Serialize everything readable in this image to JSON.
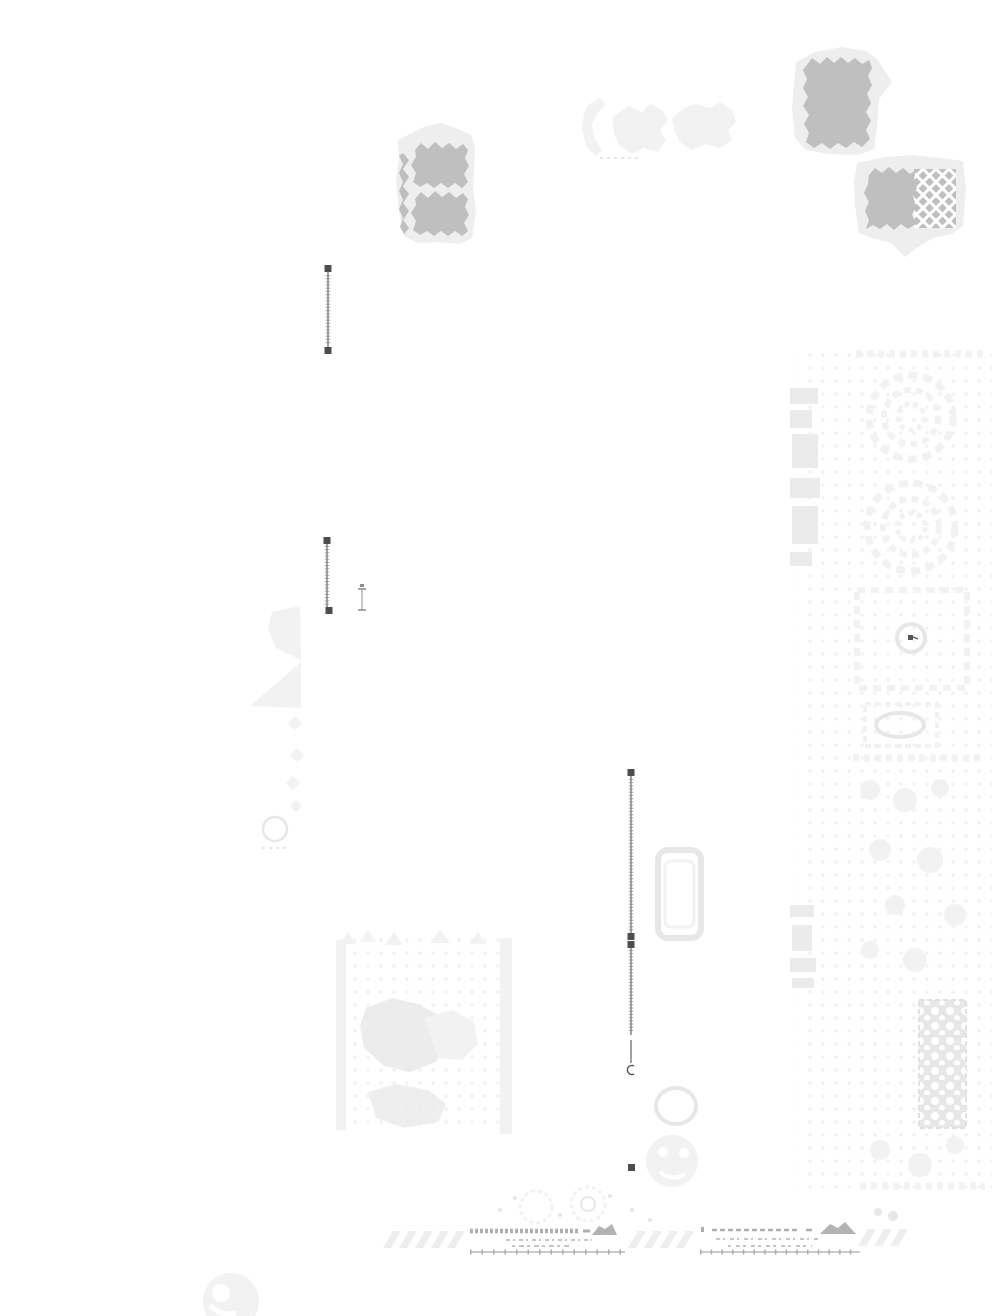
{
  "page": {
    "description": "Heavily faded scanned estate/garden plan: gray woodland blocks at top, dark vertical survey lines with square end handles, a faint formal-garden strip along the east edge, a faint orchard grid southwest of center, and two graphic scale bars with illegible script at the bottom.",
    "width_px": 1000,
    "height_px": 1316,
    "visible_text": "none legible (all inscriptions faded to illegible marks)"
  },
  "palette": {
    "page_bg": "#ffffff",
    "block_gray": "#bfbfbf",
    "block_halo": "#eeeeee",
    "faint": "#f2f2f2",
    "faint_2": "#e7e7e7",
    "outline_gray": "#e0e0e0",
    "rail_gray": "#6e6e6e",
    "rung_gray": "#8f8f8f",
    "handle_dark": "#4d4d4d",
    "glyph_dark": "#565656",
    "ruler_gray": "#ababab",
    "band_gray": "#aeaeae",
    "script_gray": "#c6c6c6",
    "mound_gray": "#b3b3b3"
  },
  "features": {
    "woodland_blocks": [
      {
        "id": "block-a",
        "label": "gray woodland block, two stacked masses with wavy west edge, upper center-west"
      },
      {
        "id": "block-b",
        "label": "gray woodland block with pale halo pointing east, top northeast"
      },
      {
        "id": "block-c",
        "label": "gray woodland block, east half cross-hatched, halo pointing south, northeast"
      }
    ],
    "survey_lines": [
      {
        "id": "survey-line-1",
        "label": "vertical surveyed line with square end handles, upper west"
      },
      {
        "id": "survey-line-2",
        "label": "vertical surveyed line with square end handles, mid west"
      },
      {
        "id": "survey-bracket",
        "label": "short capped interval marker beside survey line 2"
      },
      {
        "id": "survey-line-3",
        "label": "long vertical surveyed line, upper span, center-east"
      },
      {
        "id": "survey-line-4",
        "label": "long vertical surveyed line, lower span, ends in small c-hook"
      },
      {
        "id": "survey-point",
        "label": "isolated square survey point, lower center"
      }
    ],
    "garden_strip": {
      "label": "faint formal-garden strip along east edge with two circular parterres, a square parterre with dark center mark, small beds and dotted plantings",
      "parterre_circle_count": 2,
      "has_dark_center_mark": true
    },
    "orchard_block": {
      "label": "faint orchard/grove grid with tree clumps, southwest of center"
    },
    "tree_line_band": {
      "label": "faint hedgerow/tree band with circle symbol, west middle"
    },
    "walled_bed": {
      "label": "faint rounded rectangular bed outline, center"
    },
    "tree_clumps": {
      "label": "faint round tree-clump symbols near lower center and bottom-left corner"
    },
    "scale_bars": [
      {
        "id": "scale-bar-left",
        "label": "graphic scale bar, serrated band, illegible script, dark mound at east end",
        "tick_count": 14
      },
      {
        "id": "scale-bar-right",
        "label": "graphic scale bar, serrated band, illegible script, dark mound at east end",
        "tick_count": 15
      }
    ],
    "zigzag_bands": {
      "label": "faint zigzag hatching flanking the scale bars",
      "group_count": 3
    }
  }
}
